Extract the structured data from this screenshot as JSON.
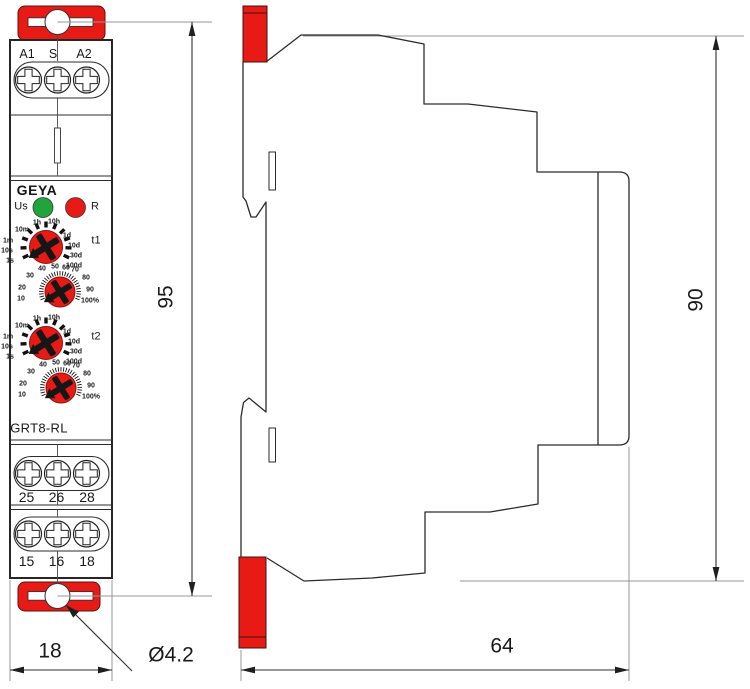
{
  "front_view": {
    "brand": "GEYA",
    "model": "GRT8-RL",
    "top_terminals": [
      "A1",
      "S",
      "A2"
    ],
    "power_led_label": "Us",
    "reset_led_label": "R",
    "timer1_label": "t1",
    "timer2_label": "t2",
    "time_scale_left": [
      "10m",
      "1m",
      "10s",
      "1s"
    ],
    "time_scale_top": [
      "1h",
      "10h"
    ],
    "time_scale_right": [
      "1d",
      "10d",
      "30d",
      "100d"
    ],
    "percent_scale": [
      "10",
      "20",
      "30",
      "40",
      "50",
      "60",
      "70",
      "80",
      "90",
      "100%"
    ],
    "middle_terminals": [
      "25",
      "26",
      "28"
    ],
    "bottom_terminals": [
      "15",
      "16",
      "18"
    ]
  },
  "dimensions": {
    "front_height_mm": "95",
    "front_width_mm": "18",
    "mounting_hole": "Ø4.2",
    "depth_mm": "64",
    "side_height_mm": "90"
  },
  "colors": {
    "accent_red": "#e81a15",
    "led_green": "#1fa53c",
    "led_red": "#e81a15"
  }
}
